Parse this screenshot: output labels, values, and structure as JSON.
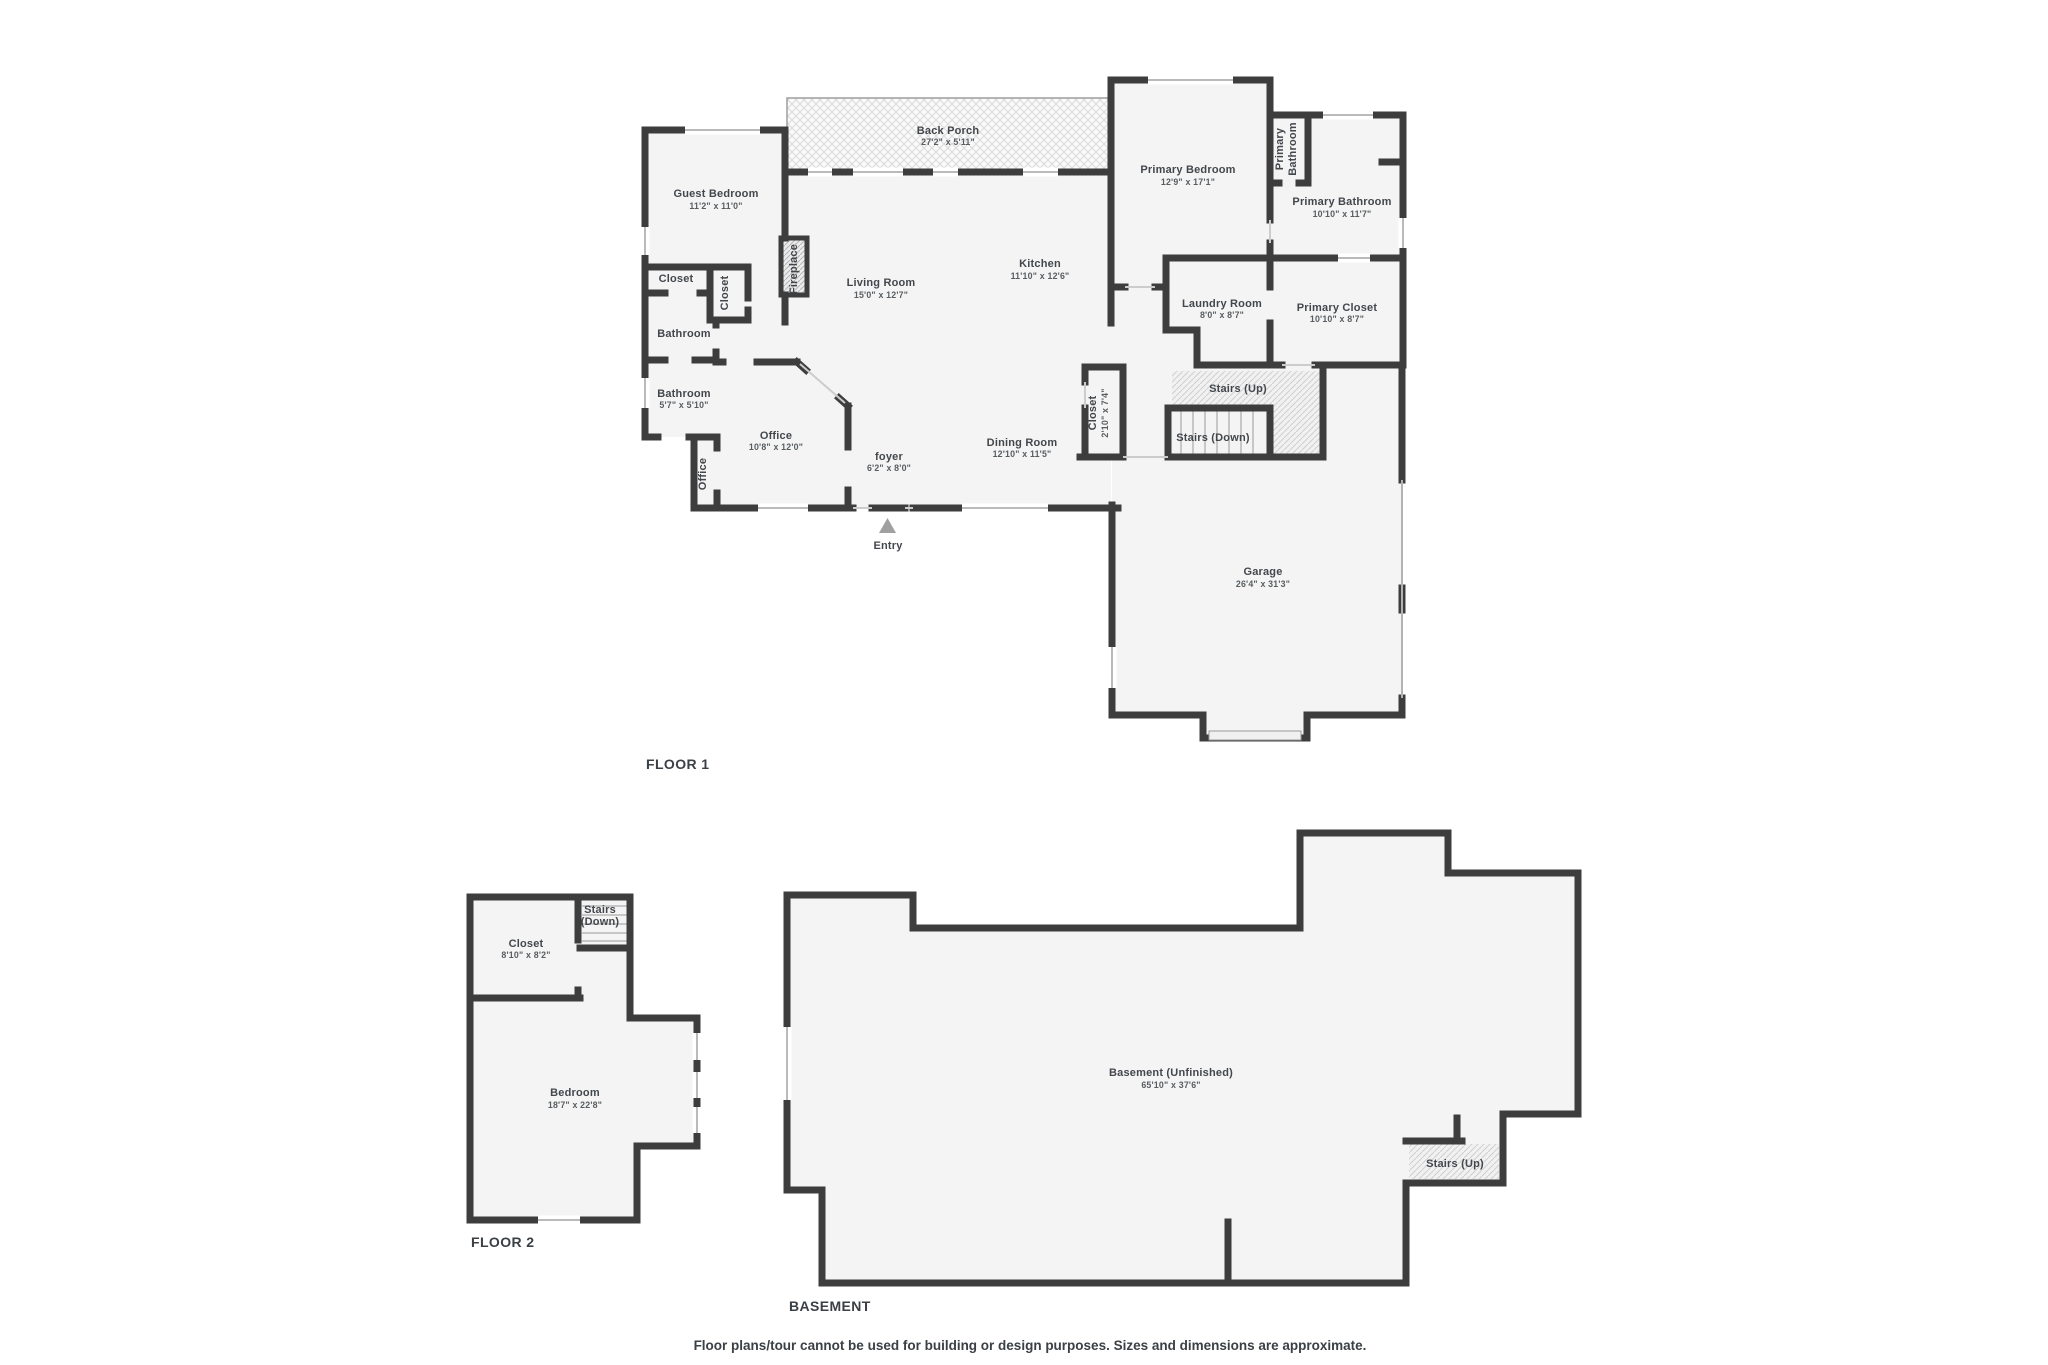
{
  "colors": {
    "wall": "#3d3d3d",
    "room_fill": "#f4f4f4",
    "hatch_line": "#d9d9d9",
    "window_line": "#a3a3a3",
    "label_text": "#43474c",
    "dims_text": "#585d61",
    "entry_marker": "#a0a0a0"
  },
  "floor1": {
    "title": "FLOOR 1",
    "rooms": [
      {
        "name": "Back Porch",
        "dims": "27'2\" x 5'11\""
      },
      {
        "name": "Guest Bedroom",
        "dims": "11'2\" x 11'0\""
      },
      {
        "name": "Closet"
      },
      {
        "name": "Closet"
      },
      {
        "name": "Fireplace"
      },
      {
        "name": "Living Room",
        "dims": "15'0\" x 12'7\""
      },
      {
        "name": "Kitchen",
        "dims": "11'10\" x 12'6\""
      },
      {
        "name": "Bathroom"
      },
      {
        "name": "Bathroom",
        "dims": "5'7\" x 5'10\""
      },
      {
        "name": "Office"
      },
      {
        "name": "Office",
        "dims": "10'8\" x 12'0\""
      },
      {
        "name": "foyer",
        "dims": "6'2\" x 8'0\""
      },
      {
        "name": "Dining Room",
        "dims": "12'10\" x 11'5\""
      },
      {
        "name": "Closet",
        "dims": "2'10\" x 7'4\""
      },
      {
        "name": "Primary Bedroom",
        "dims": "12'9\" x 17'1\""
      },
      {
        "line1": "Primary",
        "line2": "Bathroom"
      },
      {
        "name": "Primary Bathroom",
        "dims": "10'10\" x 11'7\""
      },
      {
        "name": "Laundry Room",
        "dims": "8'0\" x 8'7\""
      },
      {
        "name": "Primary Closet",
        "dims": "10'10\" x 8'7\""
      },
      {
        "name": "Stairs (Up)"
      },
      {
        "name": "Stairs (Down)"
      },
      {
        "name": "Garage",
        "dims": "26'4\" x 31'3\""
      },
      {
        "name": "Entry"
      }
    ]
  },
  "floor2": {
    "title": "FLOOR 2",
    "rooms": [
      {
        "name": "Closet",
        "dims": "8'10\" x 8'2\""
      },
      {
        "line1": "Stairs",
        "line2": "(Down)"
      },
      {
        "name": "Bedroom",
        "dims": "18'7\" x 22'8\""
      }
    ]
  },
  "basement": {
    "title": "BASEMENT",
    "rooms": [
      {
        "name": "Basement (Unfinished)",
        "dims": "65'10\" x 37'6\""
      },
      {
        "name": "Stairs (Up)"
      }
    ]
  },
  "footer": {
    "disclaimer": "Floor plans/tour cannot be used for building or design purposes. Sizes and dimensions are approximate."
  }
}
